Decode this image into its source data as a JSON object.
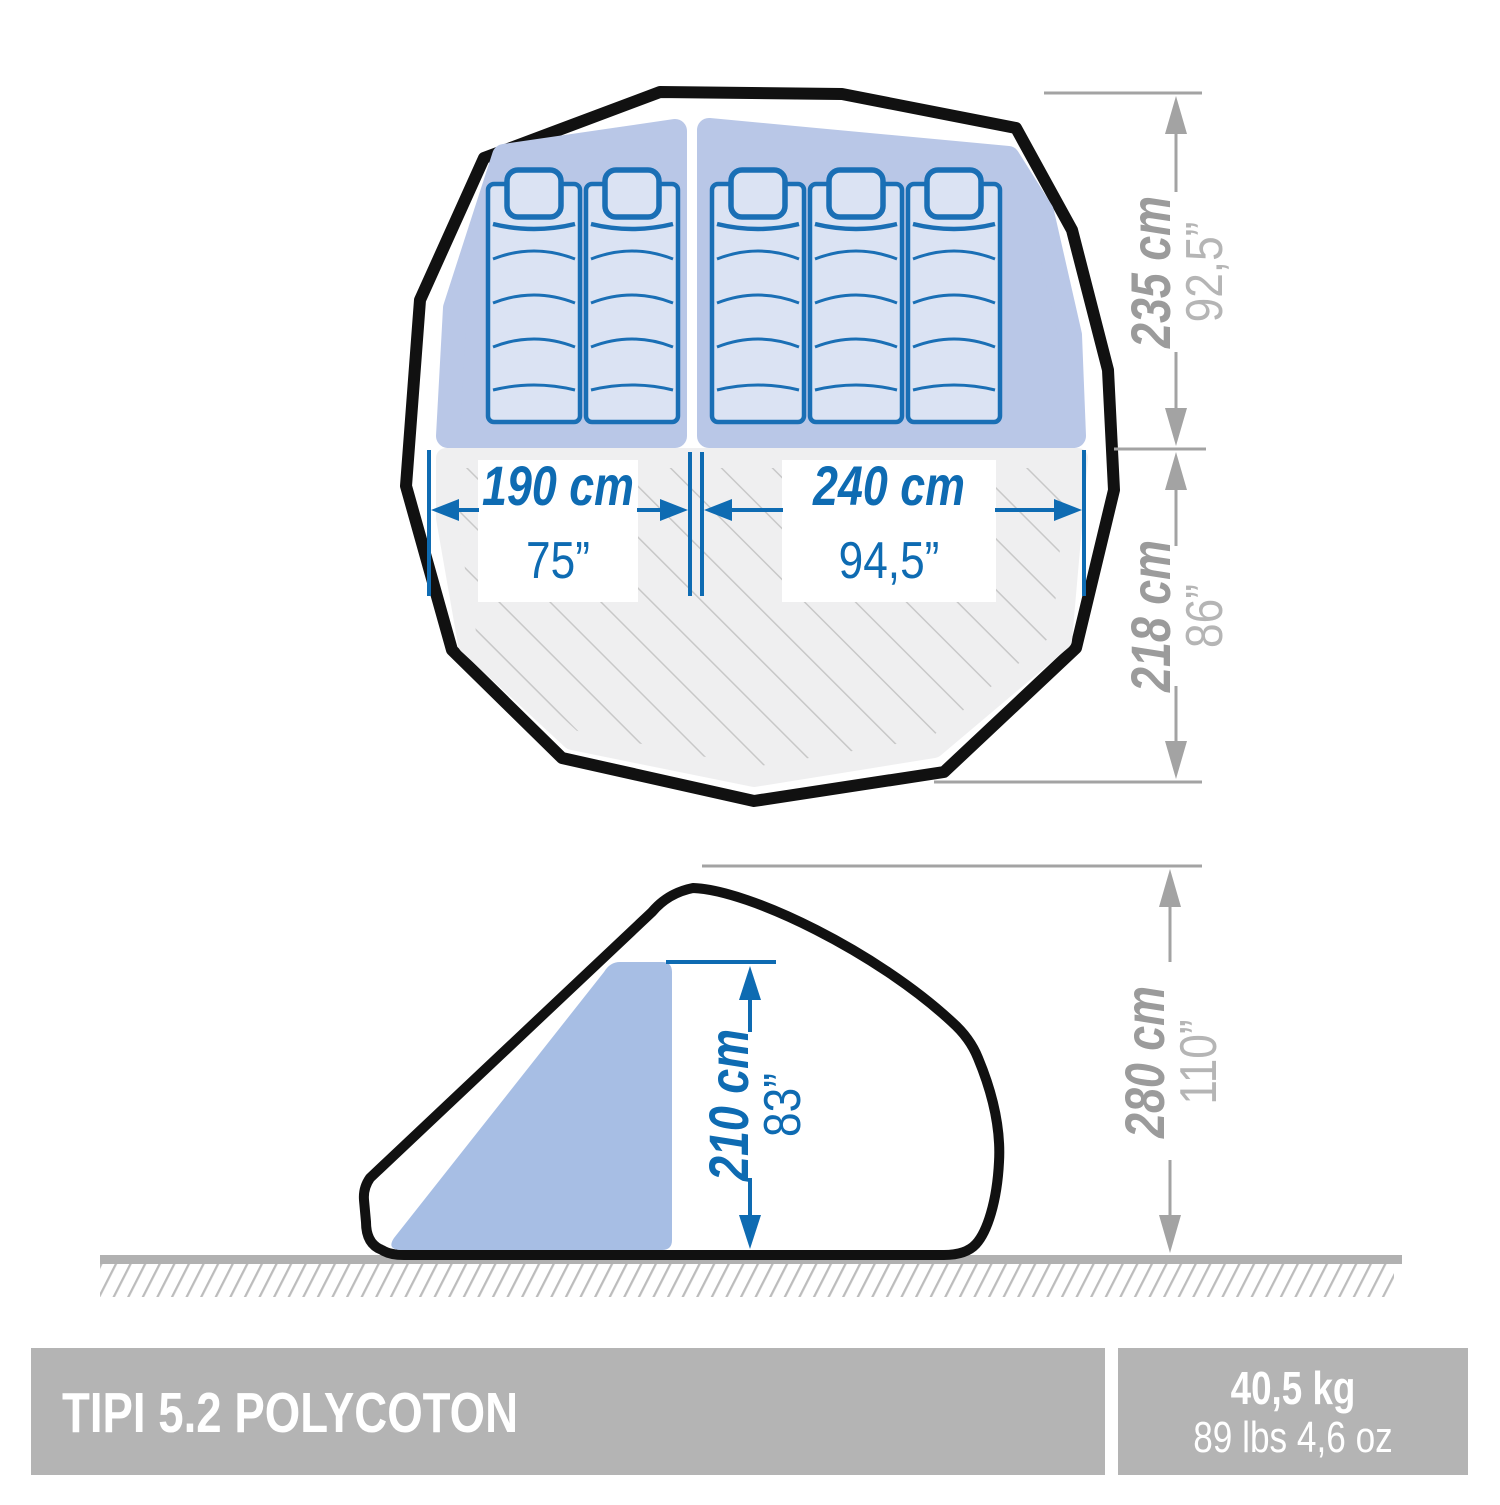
{
  "product": {
    "name": "TIPI 5.2 POLYCOTON",
    "weight_metric": "40,5 kg",
    "weight_imperial": "89 lbs 4,6 oz"
  },
  "top_view": {
    "left_compartment": {
      "width_cm": "190 cm",
      "width_in": "75”",
      "mattresses": 2
    },
    "right_compartment": {
      "width_cm": "240 cm",
      "width_in": "94,5”",
      "mattresses": 3
    },
    "sleeping_depth": {
      "cm": "235 cm",
      "in": "92,5”"
    },
    "living_depth": {
      "cm": "218 cm",
      "in": "86”"
    }
  },
  "side_view": {
    "interior_height": {
      "cm": "210 cm",
      "in": "83”"
    },
    "total_height": {
      "cm": "280 cm",
      "in": "110”"
    }
  },
  "colors": {
    "dimension_blue": "#0e6bb2",
    "mattress_stroke": "#1a6fb5",
    "sleeping_area_fill": "#b9c7e7",
    "side_area_fill": "#a7bee4",
    "mattress_fill": "#dbe3f3",
    "dim_gray": "#a3a3a3",
    "dim_gray_light": "#b5b5b5",
    "bar_gray": "#b4b4b4",
    "outline_black": "#111111"
  }
}
